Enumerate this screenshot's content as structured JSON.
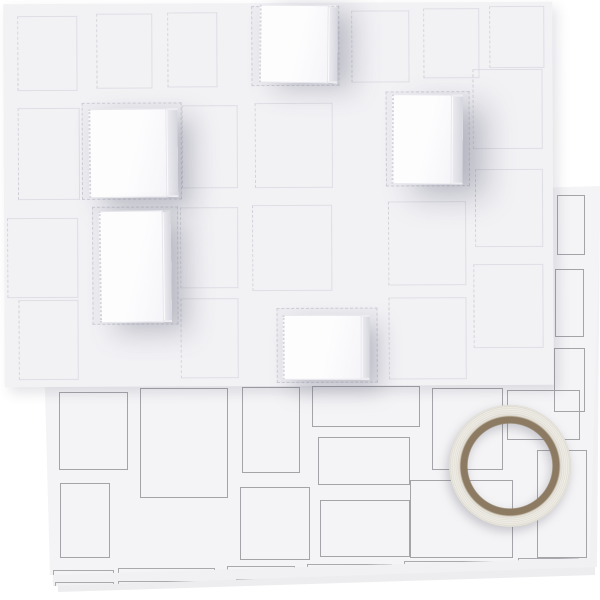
{
  "scene": {
    "description": "Product photo: white pop-out advent calendar board with five opened paper doors, lying over a stack of die-cut template sheets, with a roll of transparent double-sided adhesive tape at lower right",
    "background_color": "#ffffff"
  },
  "board": {
    "x": 4,
    "y": 3,
    "w": 549,
    "h": 383,
    "rot": -0.25,
    "bg": "#f2f2f5",
    "shadow": "5px 6px 12px rgba(90,90,110,0.16)",
    "doors": [
      [
        14,
        12,
        60,
        75
      ],
      [
        93,
        10,
        56,
        75
      ],
      [
        164,
        9,
        50,
        75
      ],
      [
        348,
        8,
        58,
        72
      ],
      [
        420,
        6,
        56,
        70
      ],
      [
        486,
        4,
        55,
        62
      ],
      [
        14,
        104,
        62,
        92
      ],
      [
        178,
        102,
        56,
        83
      ],
      [
        251,
        100,
        78,
        85
      ],
      [
        469,
        67,
        70,
        80
      ],
      [
        3,
        214,
        71,
        80
      ],
      [
        176,
        204,
        58,
        81
      ],
      [
        248,
        202,
        80,
        86
      ],
      [
        384,
        199,
        78,
        84
      ],
      [
        471,
        167,
        68,
        78
      ],
      [
        14,
        296,
        60,
        80
      ],
      [
        176,
        295,
        58,
        80
      ],
      [
        384,
        295,
        78,
        82
      ],
      [
        469,
        262,
        70,
        84
      ]
    ],
    "recesses": [
      [
        248,
        3,
        88,
        80
      ],
      [
        78,
        99,
        100,
        97
      ],
      [
        382,
        89,
        84,
        95
      ],
      [
        88,
        203,
        86,
        118
      ],
      [
        272,
        305,
        101,
        75
      ]
    ],
    "open_boxes": [
      {
        "x": 256,
        "y": 2,
        "w": 69,
        "h": 78,
        "side": 9,
        "rot": 0.8,
        "shadow": "16px 6px 26px rgba(118,118,138,0.42)"
      },
      {
        "x": 85,
        "y": 105,
        "w": 78,
        "h": 89,
        "side": 11,
        "rot": -0.4,
        "shadow": "14px 10px 26px rgba(118,118,138,0.45)"
      },
      {
        "x": 388,
        "y": 92,
        "w": 60,
        "h": 90,
        "side": 11,
        "rot": 0.6,
        "shadow": "22px 12px 30px rgba(118,118,138,0.45)"
      },
      {
        "x": 95,
        "y": 207,
        "w": 64,
        "h": 112,
        "side": 8,
        "rot": -0.5,
        "shadow": "16px 10px 26px rgba(118,118,138,0.42)"
      },
      {
        "x": 278,
        "y": 312,
        "w": 79,
        "h": 65,
        "side": 8,
        "rot": 0.2,
        "shadow": "10px 10px 22px rgba(118,118,138,0.4)"
      }
    ]
  },
  "sheets": {
    "line_color": "#a3a3a8",
    "stack": [
      {
        "name": "template-sheet-3",
        "x": 50,
        "y": 204,
        "w": 545,
        "h": 389,
        "bg": "#ededf0",
        "clip": "polygon(0px 16px,545px 0px,545px 371px,8px 388px)",
        "shadow": "0 4px 7px rgba(70,70,90,0.28)",
        "cutouts": [],
        "brackets": [],
        "edge_marks": []
      },
      {
        "name": "template-sheet-2",
        "x": 44,
        "y": 196,
        "w": 556,
        "h": 390,
        "bg": "#f1f1f4",
        "clip": "polygon(0px 17px,556px 0px,553px 371px,9px 390px)",
        "shadow": "0 3px 5px rgba(70,70,90,0.22)",
        "cutouts": [],
        "brackets": [
          [
            11,
            70,
            386
          ],
          [
            74,
            169,
            385
          ],
          [
            192,
            264,
            383
          ],
          [
            272,
            352,
            381
          ]
        ],
        "edge_marks": []
      },
      {
        "name": "template-sheet-1",
        "x": 40,
        "y": 186,
        "w": 561,
        "h": 392,
        "bg": "#f4f4f6",
        "clip": "polygon(0px 17px,561px 0px,550px 372px,10px 389px)",
        "shadow": "1px 3px 5px rgba(70,70,90,0.25)",
        "cutouts": [
          [
            19,
            206,
            69,
            78
          ],
          [
            100,
            202,
            88,
            110
          ],
          [
            202,
            201,
            58,
            86
          ],
          [
            272,
            200,
            108,
            41
          ],
          [
            278,
            251,
            92,
            48
          ],
          [
            280,
            314,
            90,
            57
          ],
          [
            370,
            294,
            103,
            78
          ],
          [
            392,
            202,
            71,
            82
          ],
          [
            467,
            204,
            73,
            50
          ],
          [
            497,
            264,
            50,
            108
          ],
          [
            200,
            301,
            70,
            73
          ],
          [
            20,
            297,
            50,
            75
          ],
          [
            517,
            9,
            28,
            60
          ],
          [
            515,
            83,
            29,
            68
          ],
          [
            514,
            162,
            31,
            64
          ]
        ],
        "brackets": [
          [
            13,
            74,
            384
          ],
          [
            78,
            175,
            382
          ],
          [
            187,
            255,
            380
          ],
          [
            267,
            352,
            378
          ],
          [
            364,
            470,
            375
          ],
          [
            478,
            539,
            372
          ]
        ],
        "edge_marks": [
          [
            4,
            206,
            288
          ],
          [
            5,
            296,
            383
          ]
        ]
      }
    ]
  },
  "tape": {
    "cx": 510,
    "cy": 466,
    "r": 61,
    "hole_ratio": 69,
    "core_color": "#8c7b62",
    "core_edge": "#9c8b71",
    "body_light": "#f1efe9",
    "body_dark": "#dedbd2",
    "shadow": "drop-shadow(-2px 4px 5px rgba(90,90,105,0.3))"
  }
}
